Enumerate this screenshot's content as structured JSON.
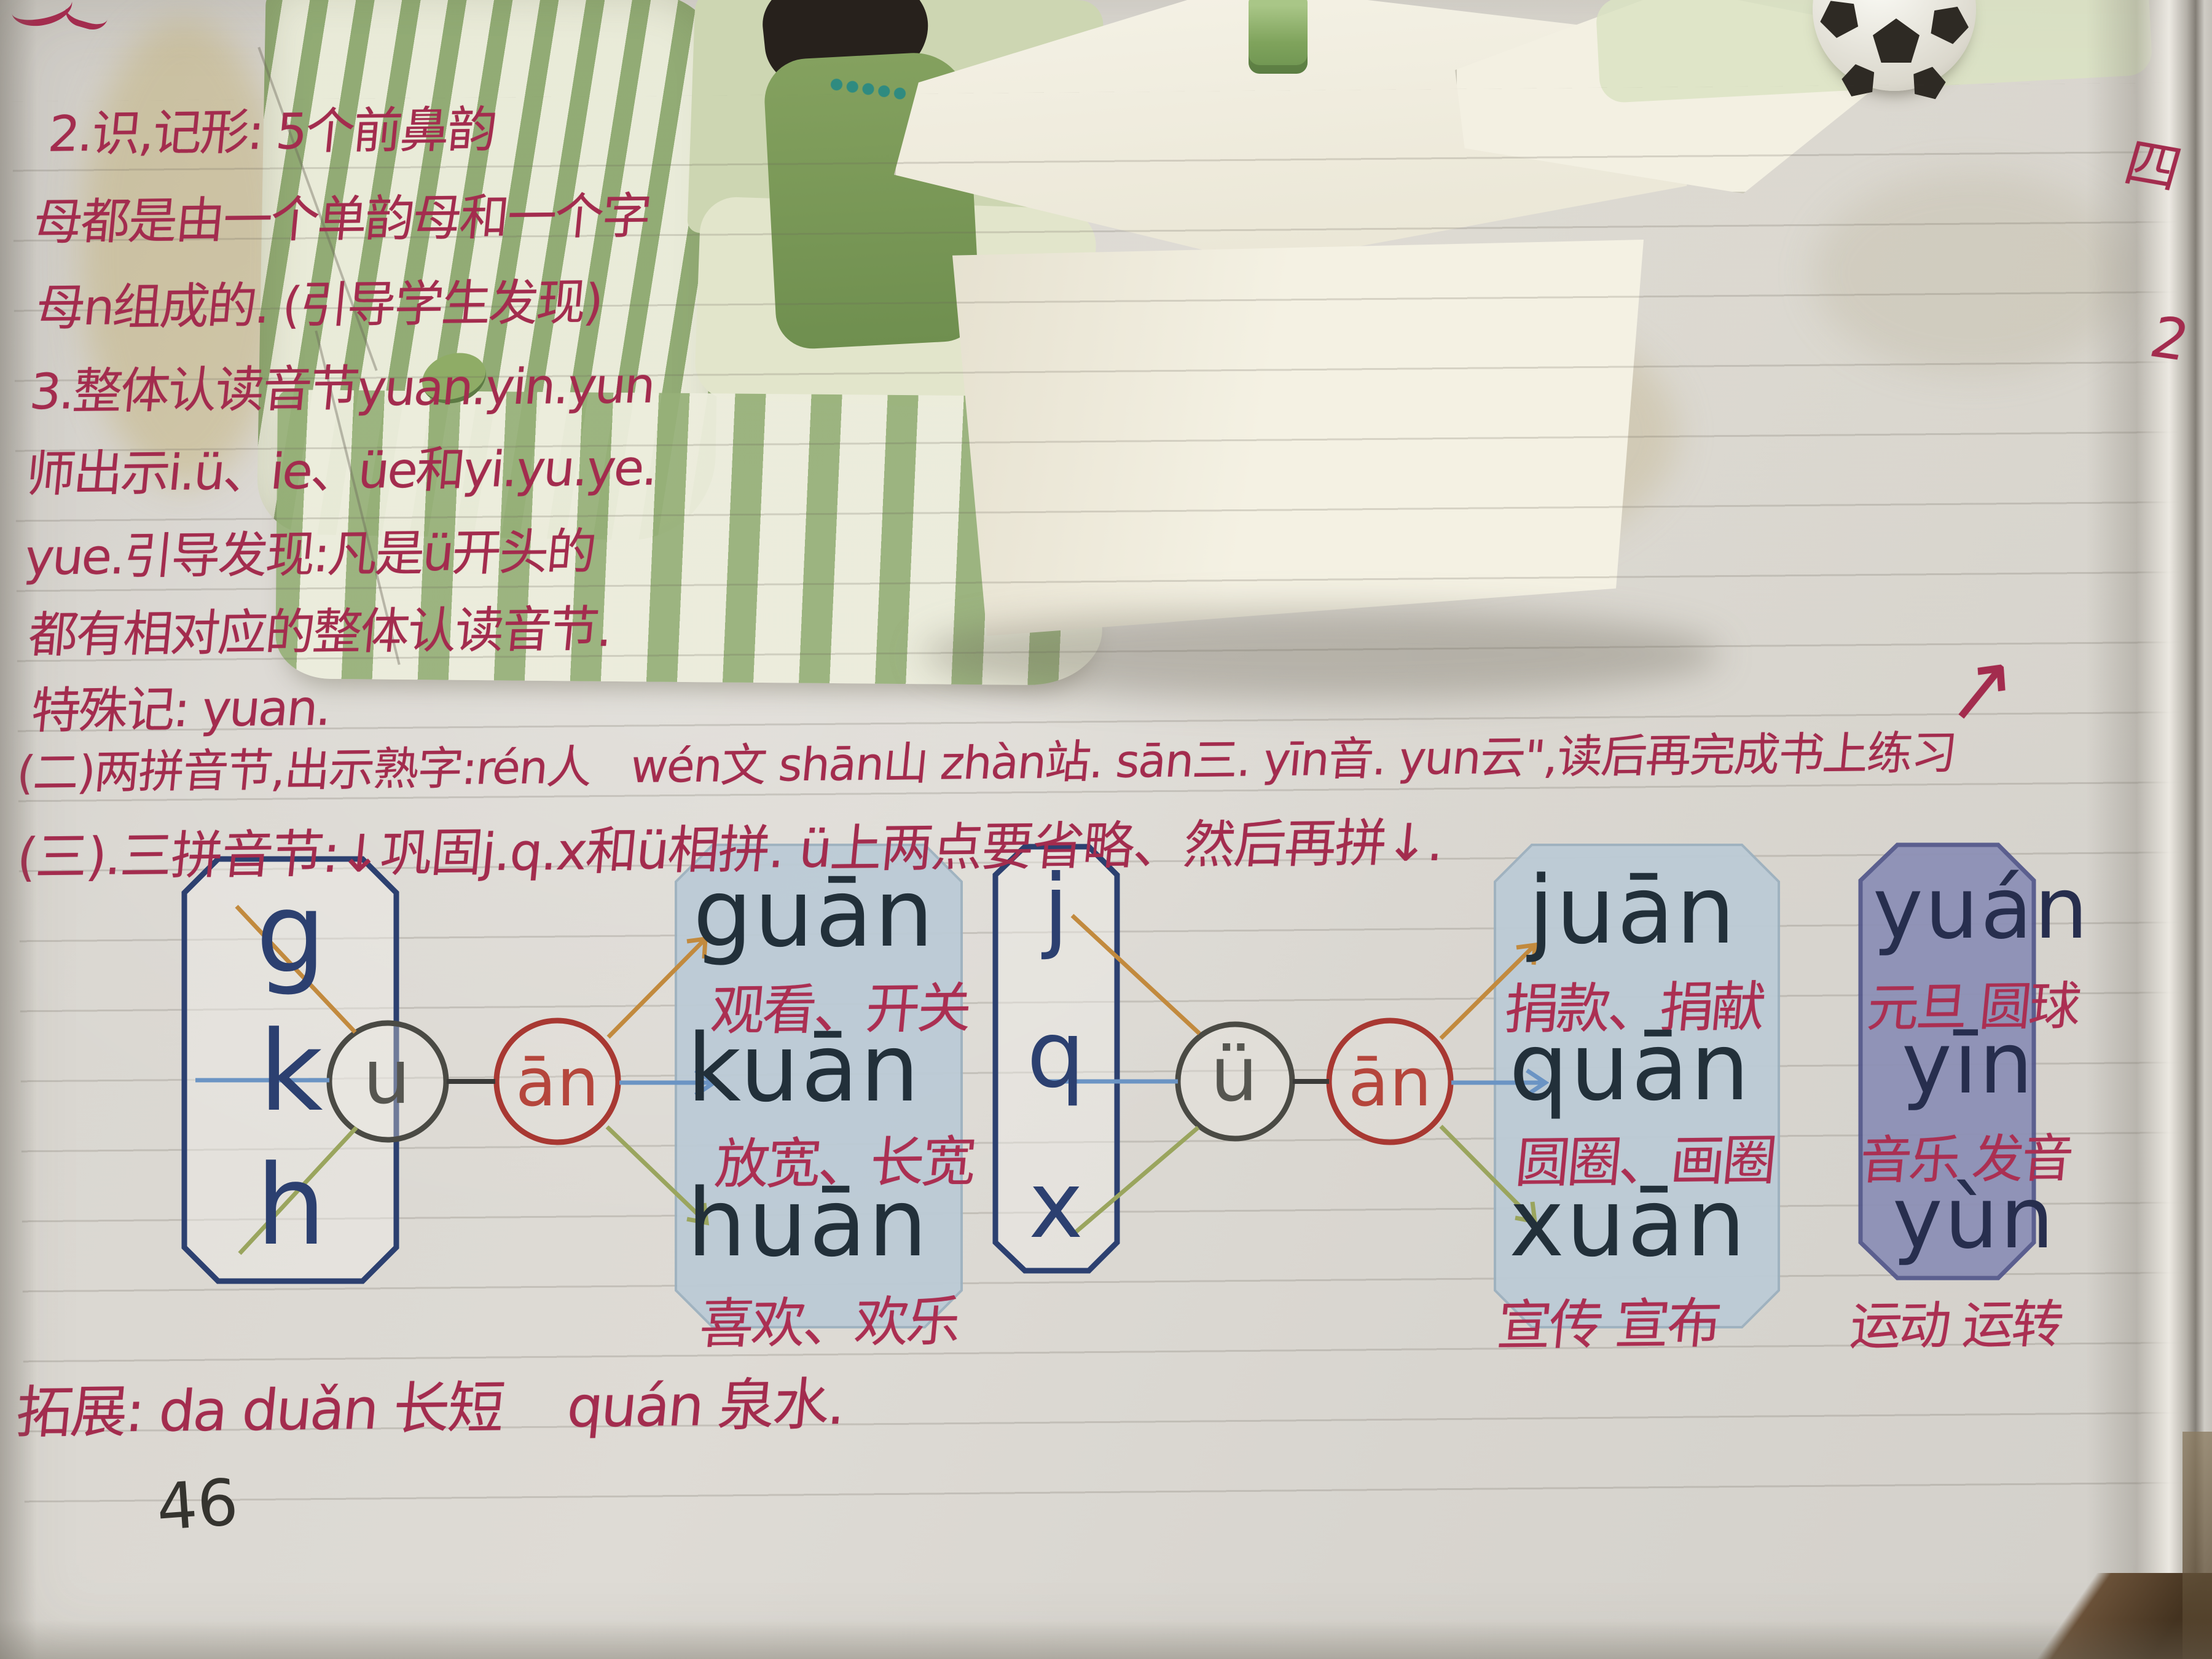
{
  "page": {
    "number": "46",
    "margin_marks": [
      "四",
      "2"
    ]
  },
  "notes": {
    "lines": [
      "2.识,记形: 5个前鼻韵",
      "母都是由一个单韵母和一个字",
      "母n组成的. (引导学生发现)",
      "3.整体认读音节yuan.yin.yun",
      "师出示i.ü、ie、üe和yi.yu.ye.",
      "yue.引导发现:凡是ü开头的",
      "都有相对应的整体认读音节.",
      "特殊记: yuan."
    ],
    "row2": "(二)两拼音节,出示熟字:rén人   wén文 shān山 zhàn站. sān三. yīn音. yun云\",读后再完成书上练习",
    "row2_arrow": "↗",
    "row3": "(三).三拼音节:↓巩固j.q.x和ü相拼. ü上两点要省略、然后再拼↓.",
    "extension": "拓展: da duǎn 长短    quán 泉水."
  },
  "diagrams": {
    "left": {
      "initials": [
        "g",
        "k",
        "h"
      ],
      "medial": "u",
      "final": "ān",
      "syllables": [
        {
          "pinyin": "guān",
          "words": "观看、开关"
        },
        {
          "pinyin": "kuān",
          "words": "放宽、长宽"
        },
        {
          "pinyin": "huān",
          "words": "喜欢、欢乐"
        }
      ]
    },
    "right": {
      "initials": [
        "j",
        "q",
        "x"
      ],
      "medial": "ü",
      "final": "ān",
      "syllables": [
        {
          "pinyin": "juān",
          "words": "捐款、捐献"
        },
        {
          "pinyin": "quān",
          "words": "圆圈、画圈"
        },
        {
          "pinyin": "xuān",
          "words": "宣传 宣布"
        }
      ]
    },
    "whole": {
      "syllables": [
        {
          "pinyin": "yuán",
          "words": "元旦 圆球"
        },
        {
          "pinyin": "yīn",
          "words": "音乐 发音"
        },
        {
          "pinyin": "yùn",
          "words": "运动 运转"
        }
      ]
    }
  },
  "colors": {
    "ink_red": "#a32c4e",
    "print_dark": "#22303a",
    "box_navy": "#2c4070",
    "circle_red": "#a83832",
    "blue_box_fill": "#bccbd6",
    "purple_box_fill": "#8d90b6",
    "line_orange": "#c28a3e",
    "line_blue": "#6b94c4",
    "line_olive": "#9aa55e"
  }
}
